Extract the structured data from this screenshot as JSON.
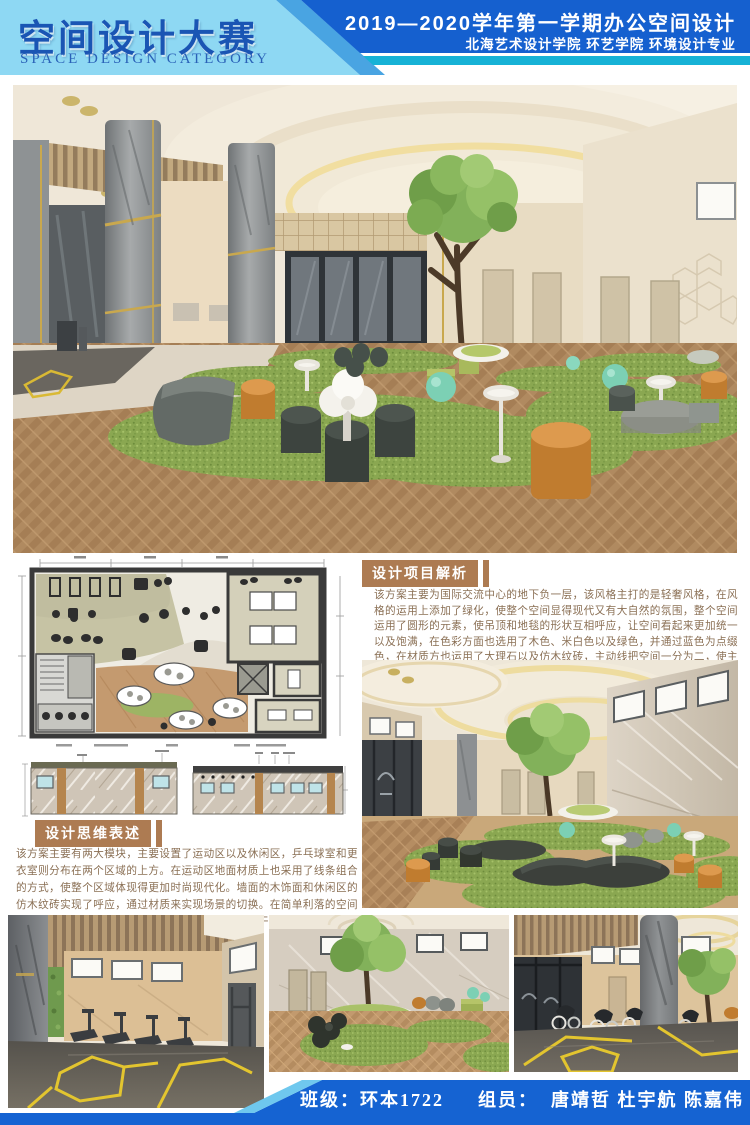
{
  "header": {
    "title": "空间设计大赛",
    "subtitle": "SPACE DESIGN CATEGORY",
    "session_line": "2019—2020学年第一学期办公空间设计",
    "school_line": "北海艺术设计学院 环艺学院 环境设计专业"
  },
  "sections": {
    "analysis": {
      "title": "设计项目解析",
      "body": "该方案主要为国际交流中心的地下负一层，该风格主打的是轻奢风格，在风格的运用上添加了绿化，使整个空间显得现代又有大自然的氛围，整个空间运用了圆形的元素，使吊顶和地毯的形状互相呼应，让空间看起来更加统一以及饱满，在色彩方面也选用了木色、米白色以及绿色，并通过蓝色为点缀色，在材质方也运用了大理石以及仿木纹砖，主动线把空间一分为二，使主动线和其他动线互不冲突和干扰。"
    },
    "thinking": {
      "title": "设计思维表述",
      "body": "该方案主要有两大模块，主要设置了运动区以及休闲区，乒乓球室和更衣室则分布在两个区域的上方。在运动区地面材质上也采用了线条组合的方式，使整个区域体现得更加时尚现代化。墙面的木饰面和休闲区的仿木纹砖实现了呼应，通过材质来实现场景的切换。在简单利落的空间格局中，各场域紧密地串联合一，使整个风格统一干练。"
    }
  },
  "footer": {
    "class_label": "班级：",
    "class_value": "环本1722",
    "members_label": "组员：",
    "members": "唐靖哲 杜宇航 陈嘉伟 伍毅"
  },
  "palette": {
    "header_light_blue": "#8ed8f3",
    "header_dark_blue": "#1560cf",
    "accent_teal": "#17b2d6",
    "title_blue": "#1a55b4",
    "section_brown": "#ad7b52",
    "body_text_brown": "#8a6f54",
    "footer_blue": "#1563d2",
    "grass_green": "#8cab53",
    "wood_tan": "#b08a60",
    "pouf_orange": "#cd8435"
  }
}
